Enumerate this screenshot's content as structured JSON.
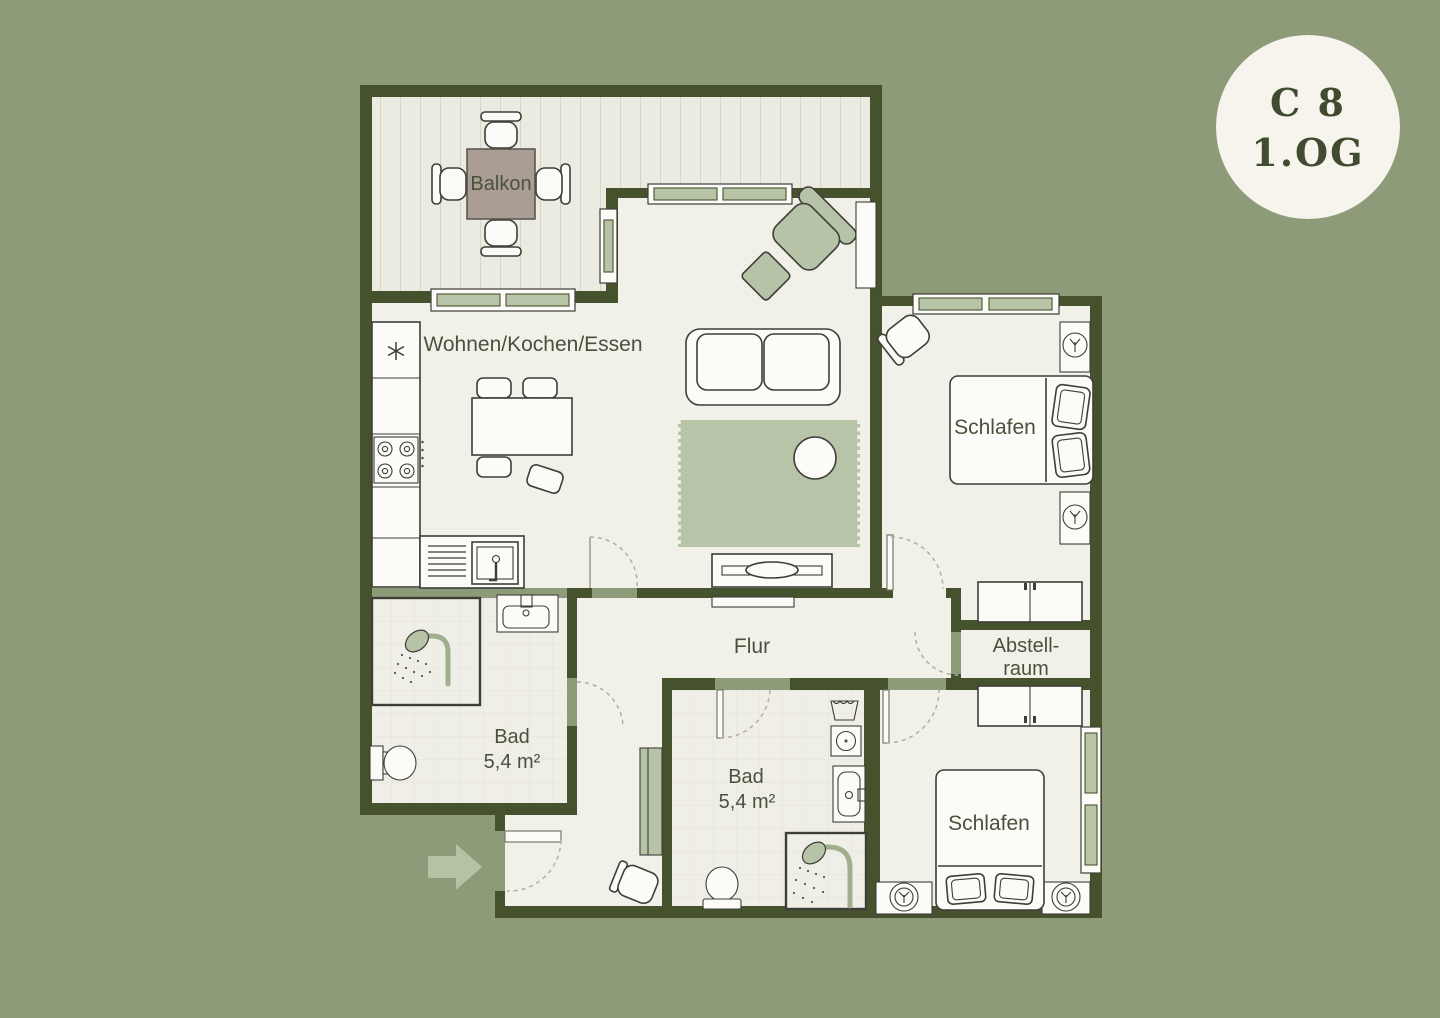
{
  "badge": {
    "line1": "C 8",
    "line2": "1.OG"
  },
  "rooms": {
    "balkon": {
      "label": "Balkon"
    },
    "wohnen": {
      "label": "Wohnen/Kochen/Essen"
    },
    "schlafen_top": {
      "label": "Schlafen"
    },
    "schlafen_bottom": {
      "label": "Schlafen"
    },
    "flur": {
      "label": "Flur"
    },
    "abstellraum": {
      "line1": "Abstell-",
      "line2": "raum"
    },
    "bad_left": {
      "label": "Bad",
      "area": "5,4 m²"
    },
    "bad_bottom": {
      "label": "Bad",
      "area": "5,4 m²"
    }
  },
  "colors": {
    "background": "#8D9B78",
    "wall": "#46522E",
    "floor": "#F2F1E9",
    "deck": "#ECEBE1",
    "deck_stripe": "#CDCCC1",
    "tile_line": "#E3E2D8",
    "window_pane": "#B8C4A8",
    "furniture_green": "#B6C3A7",
    "furniture_outline": "#3D3E38",
    "furniture_white": "#FCFBF7",
    "balcony_table": "#AA9D94",
    "label_text": "#49523C",
    "badge_background": "#F7F4ED",
    "badge_text": "#414B2F",
    "entrance_arrow": "#B5C2A4"
  },
  "icons": {
    "entrance-arrow-icon": "right arrow",
    "freezer-icon": "snowflake asterisk",
    "cooktop-icon": "4 burner circles",
    "kitchen-sink-icon": "basin with drainer",
    "shower-icon": "shower head with spray",
    "toilet-icon": "toilet bowl",
    "washbasin-icon": "basin with faucet",
    "washing-machine-icon": "square with drum circle",
    "laundry-basket-icon": "trapezoid basket",
    "door-swing-icon": "dashed quarter arc",
    "window-icon": "green glazing bar",
    "lamp-icon": "circle on nightstand"
  }
}
